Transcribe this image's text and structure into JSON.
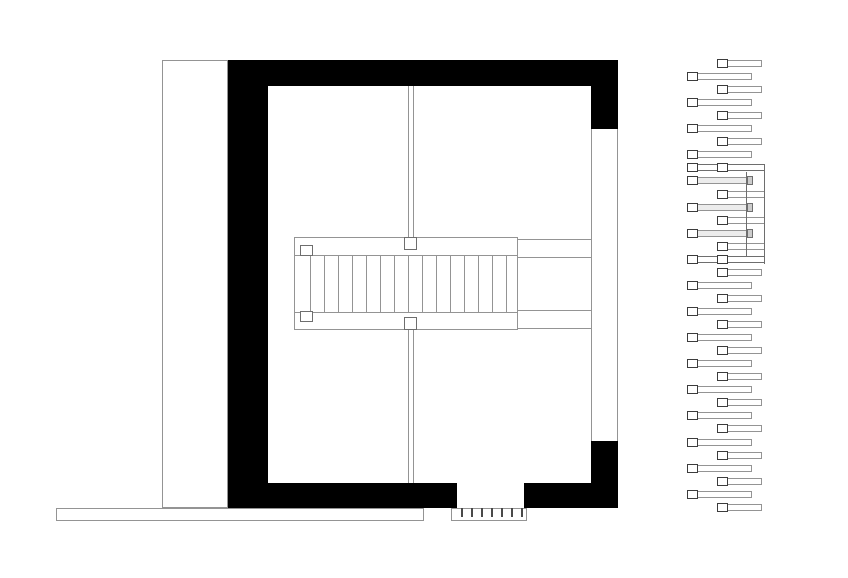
{
  "canvas": {
    "width": 848,
    "height": 578,
    "background": "#ffffff"
  },
  "colors": {
    "wall": "#000000",
    "line": "#949494",
    "line_mid": "#6e6e6e",
    "line_dark": "#3c3c3c",
    "fill_white": "#ffffff",
    "fill_light": "#ececec",
    "cap_fill": "#cccccc",
    "tick": "#4a4a4a"
  },
  "plan": {
    "annex": {
      "x": 162,
      "y": 60,
      "w": 66,
      "h": 448
    },
    "terrace": {
      "x": 56,
      "y": 508,
      "w": 368,
      "h": 13
    },
    "walls": [
      {
        "name": "wall-top",
        "x": 228,
        "y": 60,
        "w": 390,
        "h": 26
      },
      {
        "name": "wall-left",
        "x": 228,
        "y": 60,
        "w": 40,
        "h": 448
      },
      {
        "name": "wall-right-upper",
        "x": 591,
        "y": 60,
        "w": 27,
        "h": 69
      },
      {
        "name": "wall-right-lower",
        "x": 591,
        "y": 441,
        "w": 27,
        "h": 67
      },
      {
        "name": "wall-bottom-left",
        "x": 228,
        "y": 483,
        "w": 229,
        "h": 25
      },
      {
        "name": "wall-bottom-right",
        "x": 524,
        "y": 483,
        "w": 94,
        "h": 25
      }
    ],
    "window_right": {
      "x": 591,
      "y": 129,
      "w": 27,
      "h": 312
    },
    "partition_upper": {
      "x": 408,
      "y": 86,
      "w": 6,
      "h": 152
    },
    "partition_lower": {
      "x": 408,
      "y": 330,
      "w": 6,
      "h": 153
    },
    "stair": {
      "box": {
        "x": 294,
        "y": 237,
        "w": 224,
        "h": 93
      },
      "inner_top_y": 255,
      "inner_bottom_y": 312,
      "treads": {
        "x0": 310,
        "count": 15,
        "step": 14,
        "y": 255,
        "h": 57
      },
      "posts": [
        {
          "name": "stair-newel-top-left",
          "x": 300,
          "y": 245,
          "w": 13,
          "h": 11
        },
        {
          "name": "stair-newel-bottom-left",
          "x": 300,
          "y": 311,
          "w": 13,
          "h": 11
        },
        {
          "name": "stair-post-top-center",
          "x": 404,
          "y": 237,
          "w": 13,
          "h": 13
        },
        {
          "name": "stair-post-bottom-center",
          "x": 404,
          "y": 317,
          "w": 13,
          "h": 13
        }
      ],
      "landing_lines": [
        {
          "y": 239
        },
        {
          "y": 257
        },
        {
          "y": 310
        },
        {
          "y": 328
        }
      ],
      "landing_x0": 518,
      "landing_x1": 591
    },
    "door": {
      "stoop": {
        "x": 451,
        "y": 508,
        "w": 76,
        "h": 13
      },
      "ticks": {
        "x0": 461,
        "count": 7,
        "step": 10,
        "y": 508,
        "h": 9,
        "w": 2
      }
    }
  },
  "section": {
    "geometry": {
      "left_x": 687,
      "left_w": 65,
      "right_x": 717,
      "right_w": 45,
      "double_x": 687,
      "double_w": 78,
      "cap_x": 687,
      "cap_w": 61,
      "long_right_w": 48,
      "bar_h": 7,
      "square_w": 11,
      "square_h": 9
    },
    "rows": [
      {
        "y": 60,
        "type": "right"
      },
      {
        "y": 73,
        "type": "left"
      },
      {
        "y": 86,
        "type": "right"
      },
      {
        "y": 99,
        "type": "left"
      },
      {
        "y": 112,
        "type": "right"
      },
      {
        "y": 125,
        "type": "left"
      },
      {
        "y": 138,
        "type": "right"
      },
      {
        "y": 151,
        "type": "left"
      },
      {
        "y": 164,
        "type": "double"
      },
      {
        "y": 177,
        "type": "left_cap"
      },
      {
        "y": 191,
        "type": "right_long"
      },
      {
        "y": 204,
        "type": "left_cap"
      },
      {
        "y": 217,
        "type": "right_long"
      },
      {
        "y": 230,
        "type": "left_cap"
      },
      {
        "y": 243,
        "type": "right_long"
      },
      {
        "y": 256,
        "type": "double"
      },
      {
        "y": 269,
        "type": "right"
      },
      {
        "y": 282,
        "type": "left"
      },
      {
        "y": 295,
        "type": "right"
      },
      {
        "y": 308,
        "type": "left"
      },
      {
        "y": 321,
        "type": "right"
      },
      {
        "y": 334,
        "type": "left"
      },
      {
        "y": 347,
        "type": "right"
      },
      {
        "y": 360,
        "type": "left"
      },
      {
        "y": 373,
        "type": "right"
      },
      {
        "y": 386,
        "type": "left"
      },
      {
        "y": 399,
        "type": "right"
      },
      {
        "y": 412,
        "type": "left"
      },
      {
        "y": 425,
        "type": "right"
      },
      {
        "y": 439,
        "type": "left"
      },
      {
        "y": 452,
        "type": "right"
      },
      {
        "y": 465,
        "type": "left"
      },
      {
        "y": 478,
        "type": "right"
      },
      {
        "y": 491,
        "type": "left"
      },
      {
        "y": 504,
        "type": "right"
      }
    ],
    "connectors": [
      {
        "name": "section-rail-line-inner",
        "x": 746,
        "y1": 172,
        "y2": 256
      },
      {
        "name": "section-rail-line-outer",
        "x": 764,
        "y1": 164,
        "y2": 264
      }
    ]
  }
}
